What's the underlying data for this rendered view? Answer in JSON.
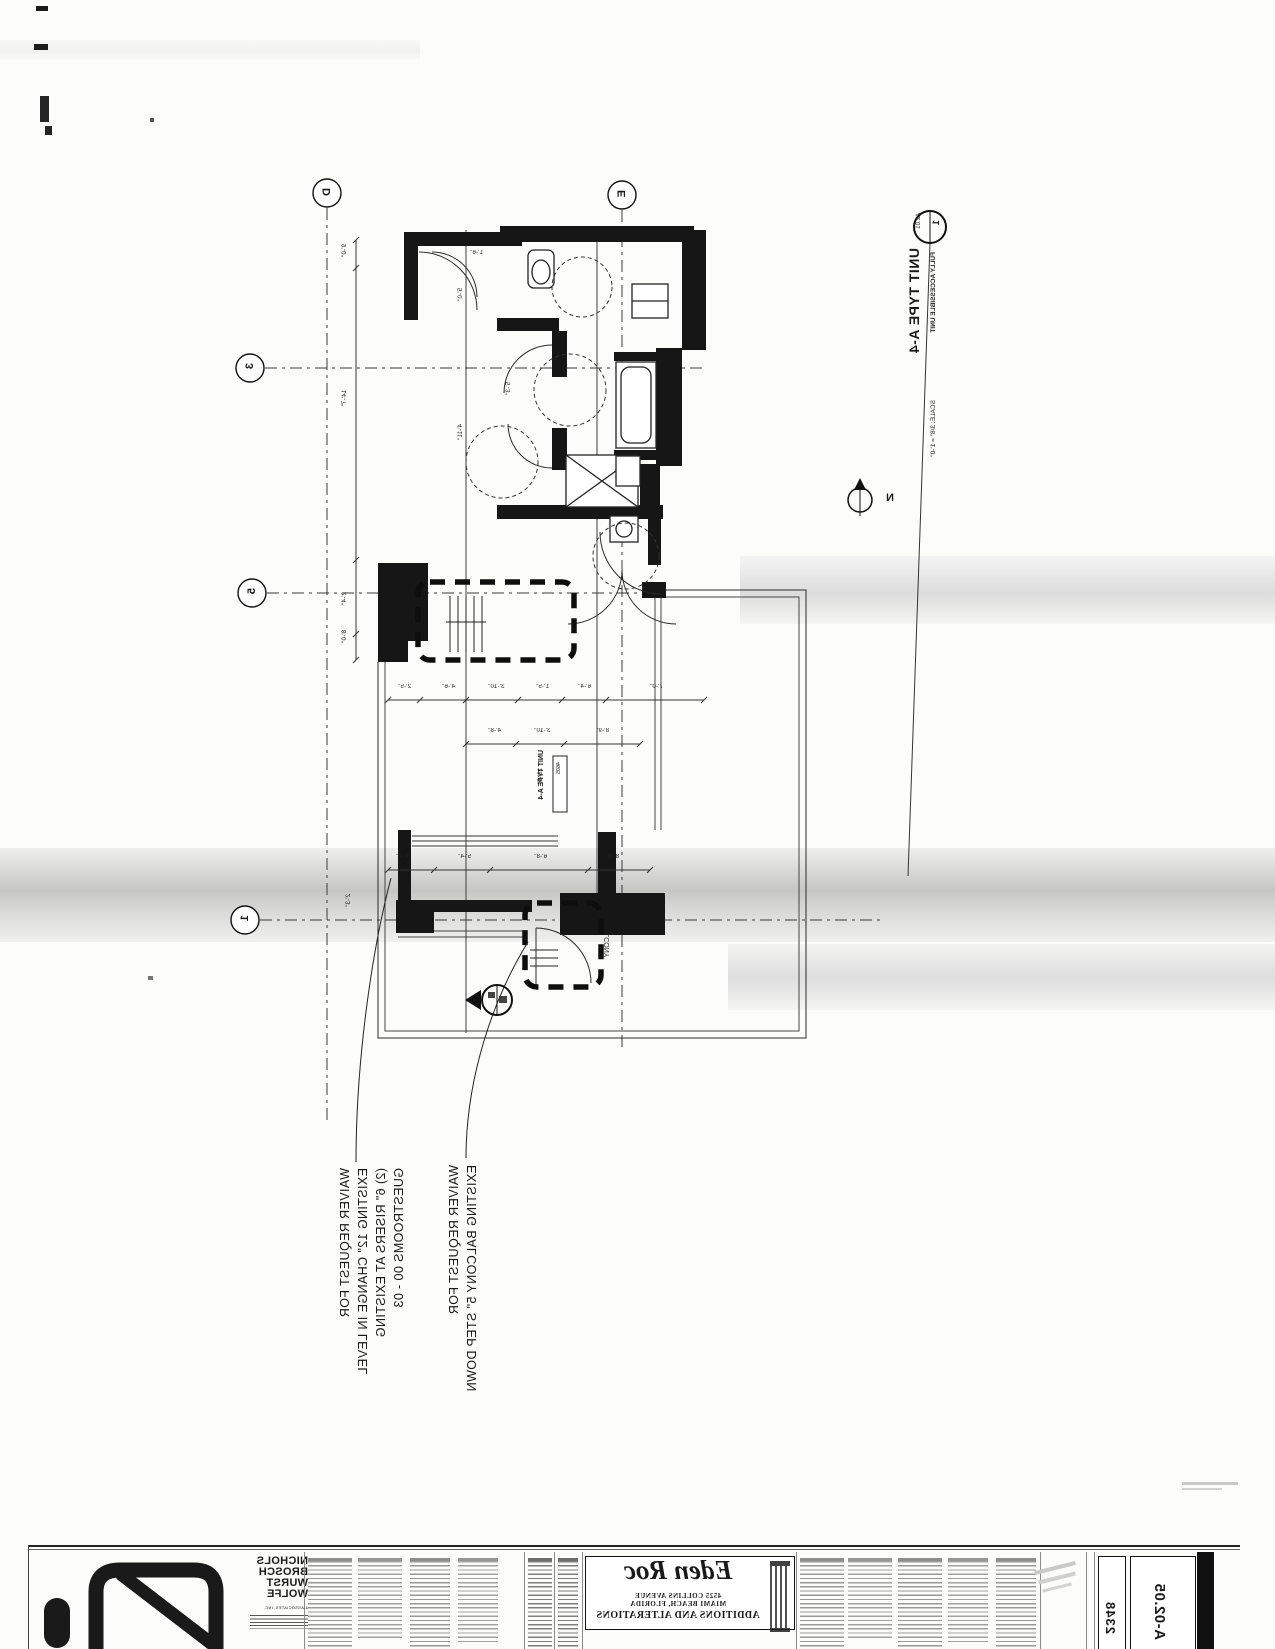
{
  "drawing_title": {
    "detail_number": "1",
    "detail_sheet": "A2.01",
    "title": "UNIT TYPE A-4",
    "subtitle": "FULLY ACCESSIBLE UNIT",
    "scale": "SCALE: 3/8\" = 1'-0\"",
    "north_label": "N"
  },
  "grid_bubbles": [
    {
      "label": "D"
    },
    {
      "label": "E"
    },
    {
      "label": "3"
    },
    {
      "label": "5"
    },
    {
      "label": "1"
    }
  ],
  "room": {
    "name": "UNIT TYPE A-4",
    "number": "4605",
    "balcony": "BALCONY"
  },
  "annotations": [
    {
      "lines": [
        "WAIVER REQUEST FOR",
        "EXISTING 12\" CHANGE IN LEVEL",
        "(2) 6\" RISERS AT EXISTING",
        "GUESTROOMS 00 - 03"
      ]
    },
    {
      "lines": [
        "WAIVER REQUEST FOR",
        "EXISTING BALCONY 5\" STEP DOWN"
      ]
    }
  ],
  "plan": {
    "dimensions": [
      {
        "text": "2'-5\"",
        "x": 398,
        "y": 684,
        "v": 0
      },
      {
        "text": "4'-6\"",
        "x": 442,
        "y": 684,
        "v": 0
      },
      {
        "text": "3'-10\"",
        "x": 488,
        "y": 684,
        "v": 0
      },
      {
        "text": "1'-5\"",
        "x": 536,
        "y": 684,
        "v": 0
      },
      {
        "text": "6'-4\"",
        "x": 578,
        "y": 684,
        "v": 0
      },
      {
        "text": "7'-0\"",
        "x": 650,
        "y": 684,
        "v": 0
      },
      {
        "text": "4'-8\"",
        "x": 488,
        "y": 728,
        "v": 0
      },
      {
        "text": "3'-10\"",
        "x": 534,
        "y": 728,
        "v": 0
      },
      {
        "text": "8'-9\"",
        "x": 596,
        "y": 728,
        "v": 0
      },
      {
        "text": "1'-7\"",
        "x": 396,
        "y": 854,
        "v": 0
      },
      {
        "text": "5'-4\"",
        "x": 458,
        "y": 854,
        "v": 0
      },
      {
        "text": "6'-8\"",
        "x": 534,
        "y": 854,
        "v": 0
      },
      {
        "text": "8'-9\"",
        "x": 606,
        "y": 854,
        "v": 0
      },
      {
        "text": "1'-6\"",
        "x": 470,
        "y": 250,
        "v": 0
      },
      {
        "text": "9'-0\"",
        "x": 342,
        "y": 244,
        "v": 1
      },
      {
        "text": "14'-7\"",
        "x": 342,
        "y": 390,
        "v": 1
      },
      {
        "text": "2'-4\"",
        "x": 342,
        "y": 592,
        "v": 1
      },
      {
        "text": "8'-0\"",
        "x": 342,
        "y": 630,
        "v": 1
      },
      {
        "text": "2'-3\"",
        "x": 346,
        "y": 894,
        "v": 1
      },
      {
        "text": "5'-0\"",
        "x": 458,
        "y": 288,
        "v": 1
      },
      {
        "text": "4'-11\"",
        "x": 458,
        "y": 424,
        "v": 1
      },
      {
        "text": "5'-3\"",
        "x": 506,
        "y": 382,
        "v": 1
      },
      {
        "text": "18'-5\"",
        "x": 538,
        "y": 768,
        "v": 1
      }
    ]
  },
  "title_block": {
    "firm_name_lines": [
      "NICHOLS",
      "BROSCH",
      "WURST",
      "WOLFE"
    ],
    "firm_sub": "& ASSOCIATES, INC.",
    "project_name": "Eden Roc",
    "address_line1": "4525 COLLINS AVENUE",
    "address_line2": "MIAMI BEACH, FLORIDA",
    "project_type": "ADDITIONS AND ALTERATIONS",
    "project_number": "2348",
    "sheet_number": "A-02.05"
  },
  "colors": {
    "ink": "#1a1a1a",
    "scan_band": "#c9c9c9"
  }
}
